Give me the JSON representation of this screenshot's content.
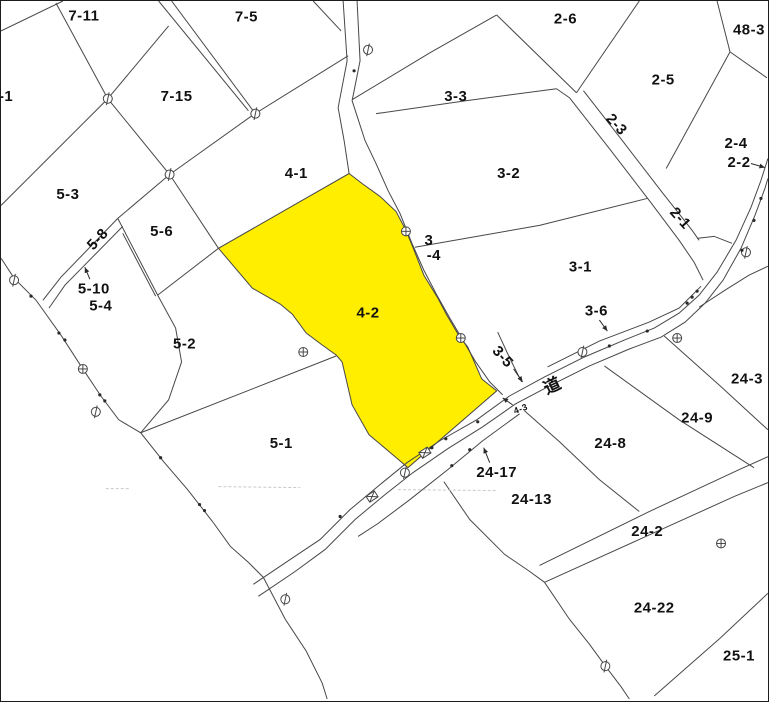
{
  "map": {
    "type": "cadastral-parcel-map",
    "background_color": "#ffffff",
    "line_color": "#474747",
    "text_color": "#111111",
    "highlight_color": "#ffee00",
    "highlighted_parcel": "4-2",
    "road_label": "道",
    "labels": [
      {
        "text": "7-11",
        "x": 83,
        "y": 15
      },
      {
        "text": "7-5",
        "x": 246,
        "y": 16
      },
      {
        "text": "2-6",
        "x": 566,
        "y": 18
      },
      {
        "text": "48-3",
        "x": 750,
        "y": 29
      },
      {
        "text": "-1",
        "x": 5,
        "y": 96
      },
      {
        "text": "7-15",
        "x": 176,
        "y": 96
      },
      {
        "text": "3-3",
        "x": 456,
        "y": 96
      },
      {
        "text": "2-5",
        "x": 664,
        "y": 79
      },
      {
        "text": "2-3",
        "x": 617,
        "y": 124,
        "rot": 48
      },
      {
        "text": "4-1",
        "x": 296,
        "y": 173
      },
      {
        "text": "2-4",
        "x": 737,
        "y": 143
      },
      {
        "text": "2-2",
        "x": 740,
        "y": 162
      },
      {
        "text": "3-2",
        "x": 509,
        "y": 173
      },
      {
        "text": "2-1",
        "x": 681,
        "y": 218,
        "rot": 48
      },
      {
        "text": "5-3",
        "x": 67,
        "y": 194
      },
      {
        "text": "5-6",
        "x": 161,
        "y": 231
      },
      {
        "text": "5-8",
        "x": 97,
        "y": 239,
        "rot": -47
      },
      {
        "text": "3",
        "x": 429,
        "y": 240
      },
      {
        "text": "-4",
        "x": 434,
        "y": 255
      },
      {
        "text": "3-1",
        "x": 581,
        "y": 267
      },
      {
        "text": "5-10",
        "x": 93,
        "y": 289
      },
      {
        "text": "5-4",
        "x": 100,
        "y": 306
      },
      {
        "text": "3-6",
        "x": 597,
        "y": 311
      },
      {
        "text": "4-2",
        "x": 368,
        "y": 313
      },
      {
        "text": "5-2",
        "x": 184,
        "y": 344
      },
      {
        "text": "3-5",
        "x": 503,
        "y": 357,
        "rot": 48
      },
      {
        "text": "24-3",
        "x": 748,
        "y": 379
      },
      {
        "text": "道",
        "x": 553,
        "y": 386,
        "rot": -25,
        "size": 17
      },
      {
        "text": "4-3",
        "x": 521,
        "y": 409,
        "rot": -20,
        "size": 9
      },
      {
        "text": "24-9",
        "x": 698,
        "y": 418
      },
      {
        "text": "24-8",
        "x": 611,
        "y": 444
      },
      {
        "text": "5-1",
        "x": 281,
        "y": 444
      },
      {
        "text": "24-17",
        "x": 497,
        "y": 473
      },
      {
        "text": "24-13",
        "x": 532,
        "y": 500
      },
      {
        "text": "24-2",
        "x": 648,
        "y": 532
      },
      {
        "text": "24-22",
        "x": 655,
        "y": 609
      },
      {
        "text": "25-1",
        "x": 740,
        "y": 657
      }
    ],
    "leader_arrows": [
      {
        "for": "2-2",
        "x1": 752,
        "y1": 163,
        "x2": 766,
        "y2": 167
      },
      {
        "for": "5-10",
        "x1": 89,
        "y1": 279,
        "x2": 84,
        "y2": 267
      },
      {
        "for": "3-6",
        "x1": 600,
        "y1": 320,
        "x2": 608,
        "y2": 331
      },
      {
        "for": "3-5",
        "x1": 514,
        "y1": 369,
        "x2": 523,
        "y2": 382
      },
      {
        "for": "4-3",
        "x1": 513,
        "y1": 405,
        "x2": 503,
        "y2": 398
      },
      {
        "for": "24-17",
        "x1": 490,
        "y1": 463,
        "x2": 484,
        "y2": 448
      }
    ],
    "survey_markers_circle_line": [
      {
        "x": 107,
        "y": 98
      },
      {
        "x": 169,
        "y": 174
      },
      {
        "x": 255,
        "y": 113
      },
      {
        "x": 368,
        "y": 49
      },
      {
        "x": 13,
        "y": 280
      },
      {
        "x": 95,
        "y": 412
      },
      {
        "x": 285,
        "y": 600
      },
      {
        "x": 405,
        "y": 473
      },
      {
        "x": 583,
        "y": 352
      },
      {
        "x": 747,
        "y": 252
      },
      {
        "x": 606,
        "y": 667
      }
    ],
    "survey_markers_circle_cross": [
      {
        "x": 82,
        "y": 369
      },
      {
        "x": 303,
        "y": 352
      },
      {
        "x": 406,
        "y": 231
      },
      {
        "x": 461,
        "y": 338
      },
      {
        "x": 678,
        "y": 338
      },
      {
        "x": 722,
        "y": 544
      }
    ],
    "boundary_dots": [
      [
        30,
        296
      ],
      [
        58,
        333
      ],
      [
        64,
        340
      ],
      [
        99,
        395
      ],
      [
        104,
        401
      ],
      [
        160,
        458
      ],
      [
        199,
        505
      ],
      [
        204,
        511
      ],
      [
        432,
        448
      ],
      [
        446,
        439
      ],
      [
        478,
        422
      ],
      [
        610,
        346
      ],
      [
        648,
        331
      ],
      [
        688,
        303
      ],
      [
        693,
        297
      ],
      [
        698,
        291
      ],
      [
        743,
        250
      ],
      [
        755,
        220
      ],
      [
        762,
        198
      ],
      [
        470,
        450
      ],
      [
        452,
        466
      ],
      [
        354,
        70
      ],
      [
        340,
        517
      ]
    ],
    "culvert_symbols": [
      {
        "x": 425,
        "y": 453,
        "rot": -33
      },
      {
        "x": 372,
        "y": 497,
        "rot": -33
      }
    ],
    "faint_dashes": [
      [
        105,
        489,
        128,
        489
      ],
      [
        218,
        487,
        300,
        488
      ],
      [
        398,
        490,
        498,
        491
      ]
    ]
  }
}
